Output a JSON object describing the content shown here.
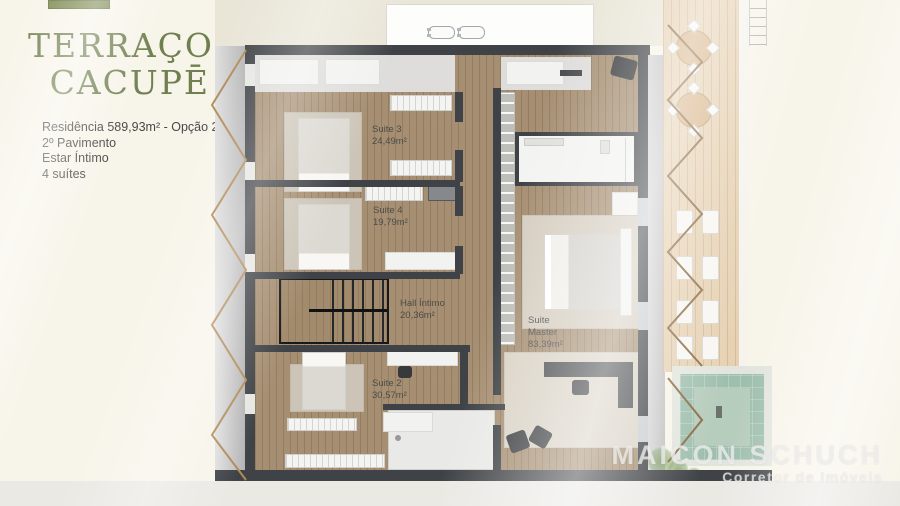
{
  "brand": {
    "title_line1": "TERRAÇO",
    "title_line2": "CACUPĒ"
  },
  "info": {
    "residence": "Residência 589,93m² - Opção 2",
    "floor": "2º Pavimento",
    "living": "Estar Íntimo",
    "suites": "4 suítes"
  },
  "floorplan": {
    "rooms": [
      {
        "name": "Suite 3",
        "area": "24,49m²",
        "label": "Suite 3\n24,49m²"
      },
      {
        "name": "Suite 4",
        "area": "19,79m²",
        "label": "Suite 4\n19,79m²"
      },
      {
        "name": "Hall Íntimo",
        "area": "20,36m²",
        "label": "Hall Íntimo\n20,36m²"
      },
      {
        "name": "Suite 2",
        "area": "30,57m²",
        "label": "Suite 2\n30,57m²"
      },
      {
        "name": "Suite Master",
        "area": "83,39m²",
        "label": "Suite\nMaster\n83,39m²"
      }
    ]
  },
  "watermark": {
    "name": "MAICON SCHUCH",
    "subtitle": "Corretor de Imóveis"
  },
  "colors": {
    "background": "#f7f4e9",
    "brand_green": "#6f7f4e",
    "logo_green": "#7b874f",
    "wall": "#3f4246",
    "wood_floor": "#a28a6c",
    "deck_wood": "#e6d1b2",
    "pool": "#9fbfae",
    "text": "#474745",
    "watermark_white": "rgba(255,255,255,0.62)"
  }
}
